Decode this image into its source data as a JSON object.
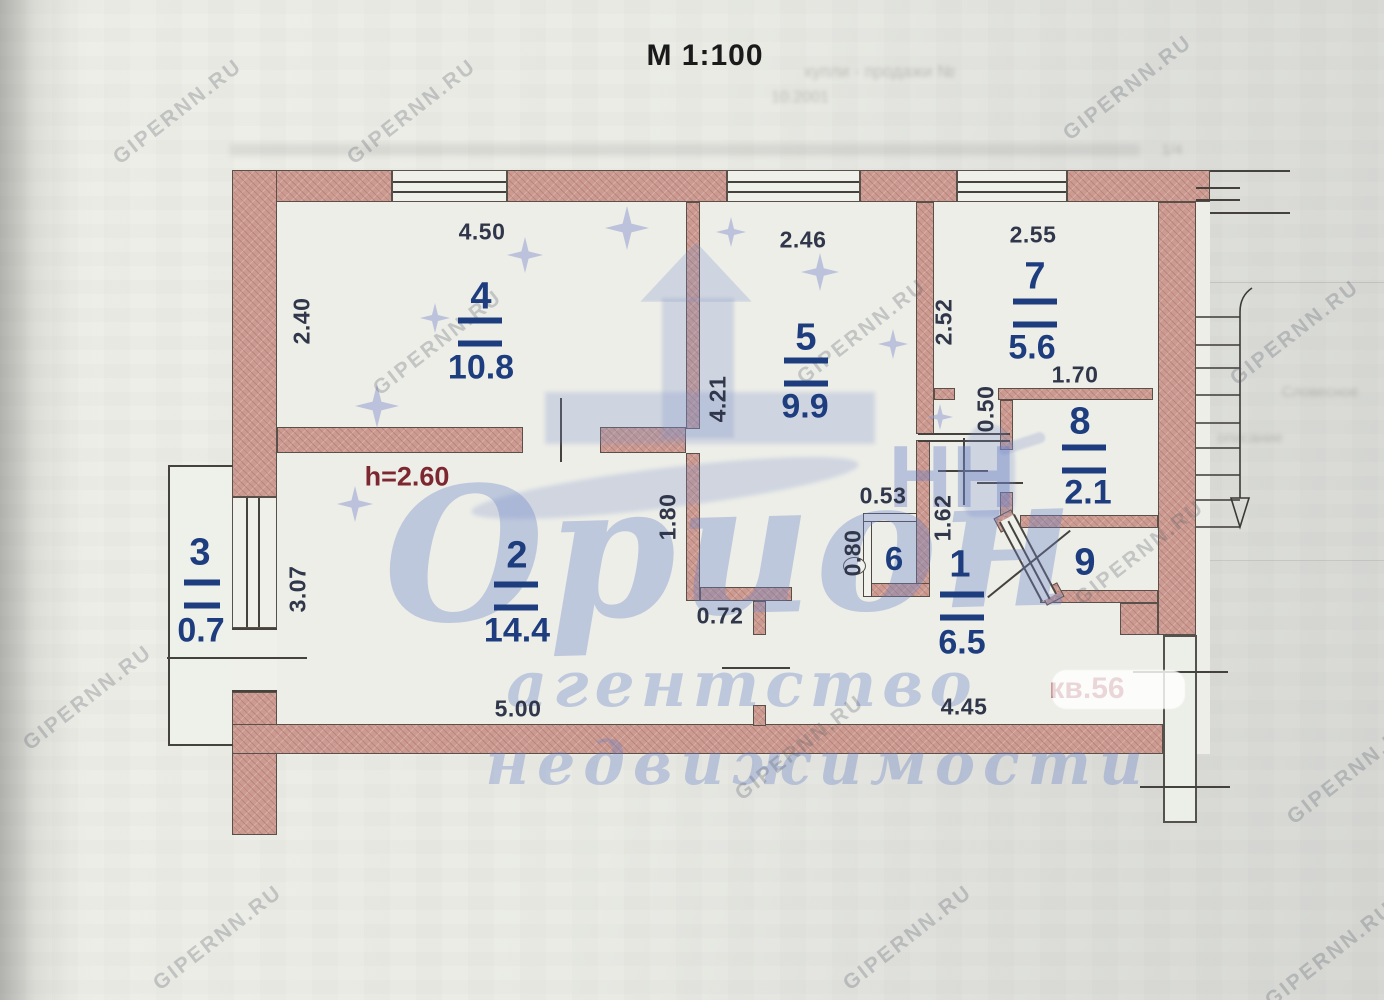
{
  "scale_title": "М 1:100",
  "rooms": [
    {
      "number": "1",
      "area": "6.5"
    },
    {
      "number": "2",
      "area": "14.4"
    },
    {
      "number": "3",
      "area": "0.7"
    },
    {
      "number": "4",
      "area": "10.8"
    },
    {
      "number": "5",
      "area": "9.9"
    },
    {
      "number": "6",
      "area": ""
    },
    {
      "number": "7",
      "area": "5.6"
    },
    {
      "number": "8",
      "area": "2.1"
    },
    {
      "number": "9",
      "area": ""
    }
  ],
  "dimensions": {
    "top_room4": "4.50",
    "top_room5": "2.46",
    "top_room7": "2.55",
    "left_room4": "2.40",
    "left_room5": "4.21",
    "room7_left": "2.52",
    "room7_bottom": "1.70",
    "entry_door": "0.50",
    "room6_width": "0.53",
    "room6_height": "0.80",
    "hall_length": "1.62",
    "room5_wall": "1.80",
    "left_room2": "3.07",
    "room2_jog": "0.72",
    "bottom_room2": "5.00",
    "bottom_room1": "4.45"
  },
  "annotations": {
    "ceiling_height": "h=2.60",
    "apartment_number": "кв.56"
  },
  "watermarks": {
    "brand": "Орион",
    "brand_nn": "НН",
    "agency": "агентство",
    "realty": "недвижимости",
    "site": "GIPERNN.RU"
  },
  "ghost_fragments": {
    "f1": "купли - продажи №",
    "f2": "10.2001",
    "f3": "Словесное",
    "f4": "описание",
    "f5": "1/4"
  }
}
